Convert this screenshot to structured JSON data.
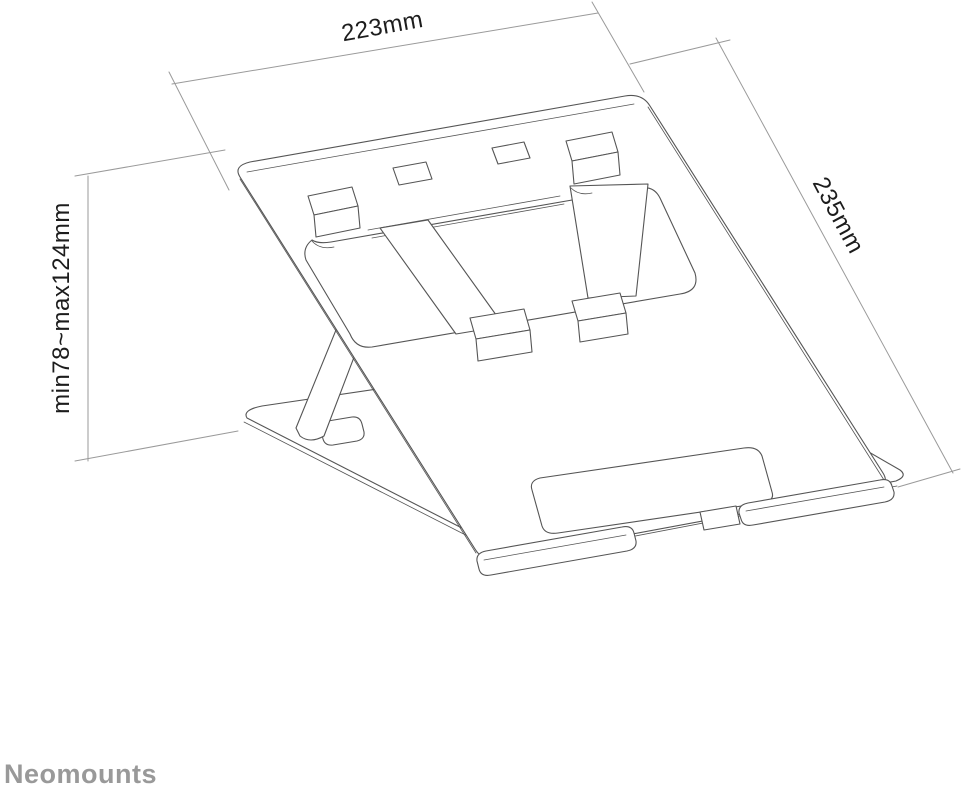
{
  "dimensions": {
    "width": "223mm",
    "depth": "235mm",
    "height": "min78~max124mm"
  },
  "brand": "Neomounts",
  "colors": {
    "background": "#ffffff",
    "drawing-line": "#555555",
    "dimension-line": "#9a9a9a",
    "dimension-text": "#1c1c1c",
    "brand-text": "#999999"
  }
}
